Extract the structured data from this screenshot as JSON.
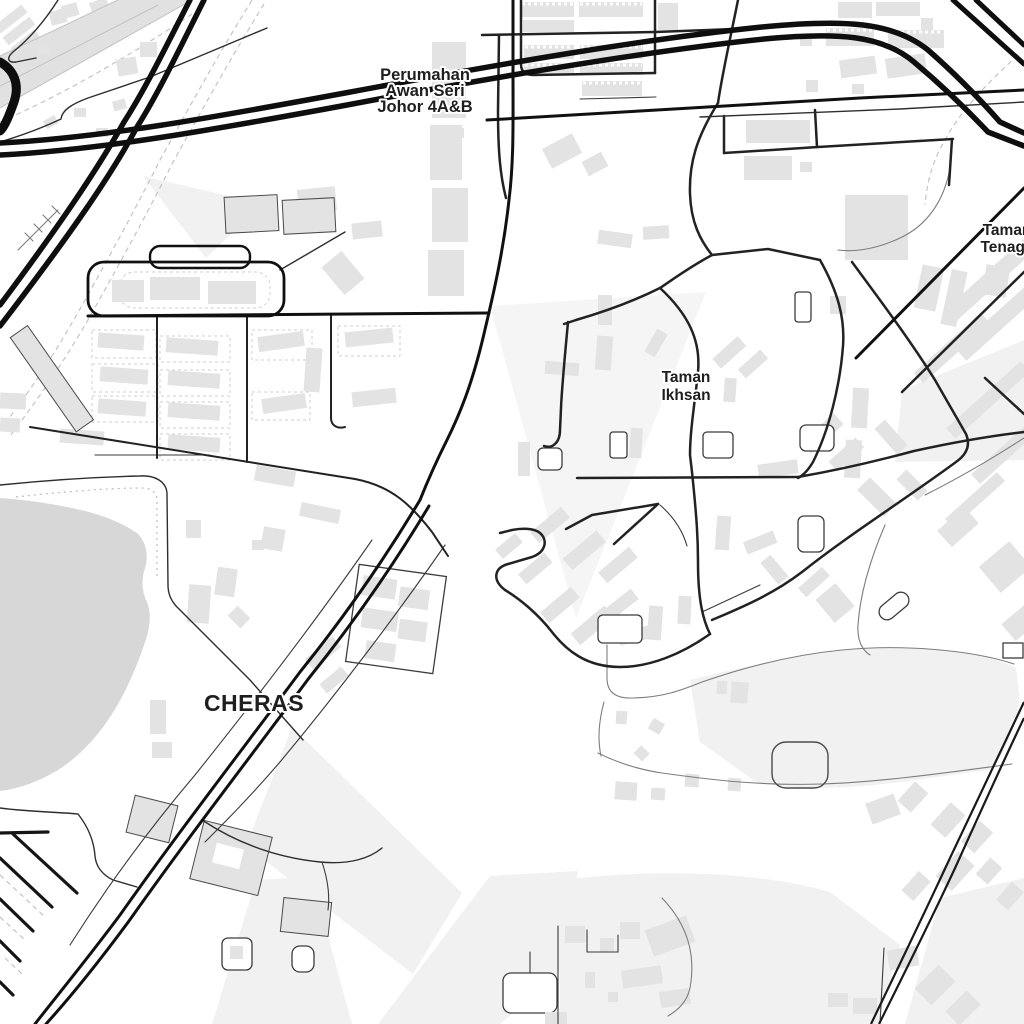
{
  "map": {
    "labels": {
      "perumahan": [
        "Perumahan",
        "Awan Seri",
        "Johor 4A&B"
      ],
      "ikhsan": [
        "Taman",
        "Ikhsan"
      ],
      "tenaga": [
        "Taman",
        "Tenaga"
      ],
      "district": "CHERAS"
    },
    "colors": {
      "background": "#ffffff",
      "building": "#e3e3e3",
      "area_pale": "#f1f1f1",
      "water": "#d7d7d7",
      "corridor": "#e1e1e1",
      "road_major": "#0e0e0e",
      "road_minor": "#222222",
      "road_path": "#7d7d7d",
      "boundary": "#c4c4c4",
      "label_text": "#1e1e1e"
    }
  }
}
